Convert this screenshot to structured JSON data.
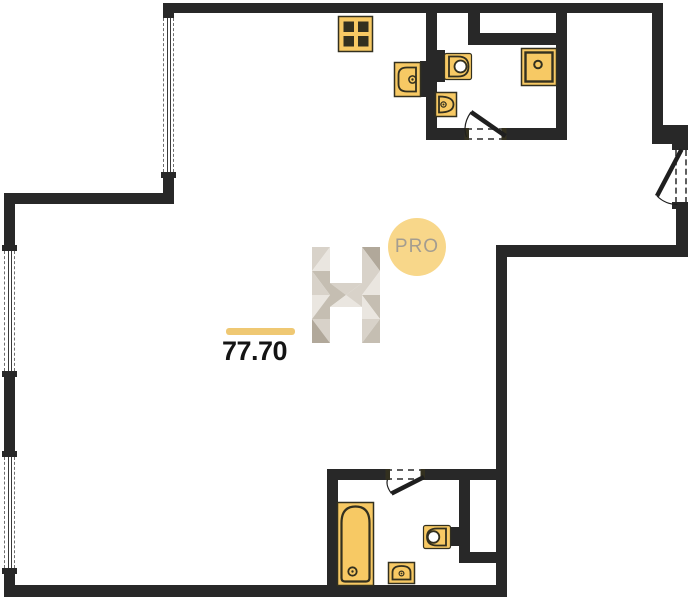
{
  "area_label": {
    "value": "77.70"
  },
  "watermark": {
    "logo_letter": "H",
    "badge_text": "PRO"
  },
  "palette": {
    "wall": "#282828",
    "fixture_fill": "#f7c964",
    "fixture_border": "#33301f",
    "accent_bar": "#efc873",
    "badge_bg": "#f8d78a",
    "badge_text": "#a49d90",
    "watermark_light": "#eae6e0",
    "watermark_mid": "#d8d2c9",
    "watermark_deep": "#c5beb2",
    "watermark_dark": "#b1a89a",
    "door_stroke": "#1f1f1f"
  },
  "fixtures": [
    {
      "name": "stove-4-burner",
      "room": "kitchen-nook"
    },
    {
      "name": "kitchen-sink",
      "room": "kitchen-nook"
    },
    {
      "name": "toilet",
      "room": "bathroom-top"
    },
    {
      "name": "washbasin",
      "room": "bathroom-top"
    },
    {
      "name": "shower",
      "room": "bathroom-top"
    },
    {
      "name": "bathtub",
      "room": "bathroom-bottom"
    },
    {
      "name": "toilet",
      "room": "bathroom-bottom"
    },
    {
      "name": "washbasin",
      "room": "bathroom-bottom"
    }
  ],
  "doors": [
    {
      "name": "bathroom-top-door"
    },
    {
      "name": "entry-door"
    },
    {
      "name": "bathroom-bottom-door"
    }
  ],
  "windows": [
    {
      "name": "window-top-left"
    },
    {
      "name": "window-left-upper"
    },
    {
      "name": "window-left-lower"
    }
  ]
}
